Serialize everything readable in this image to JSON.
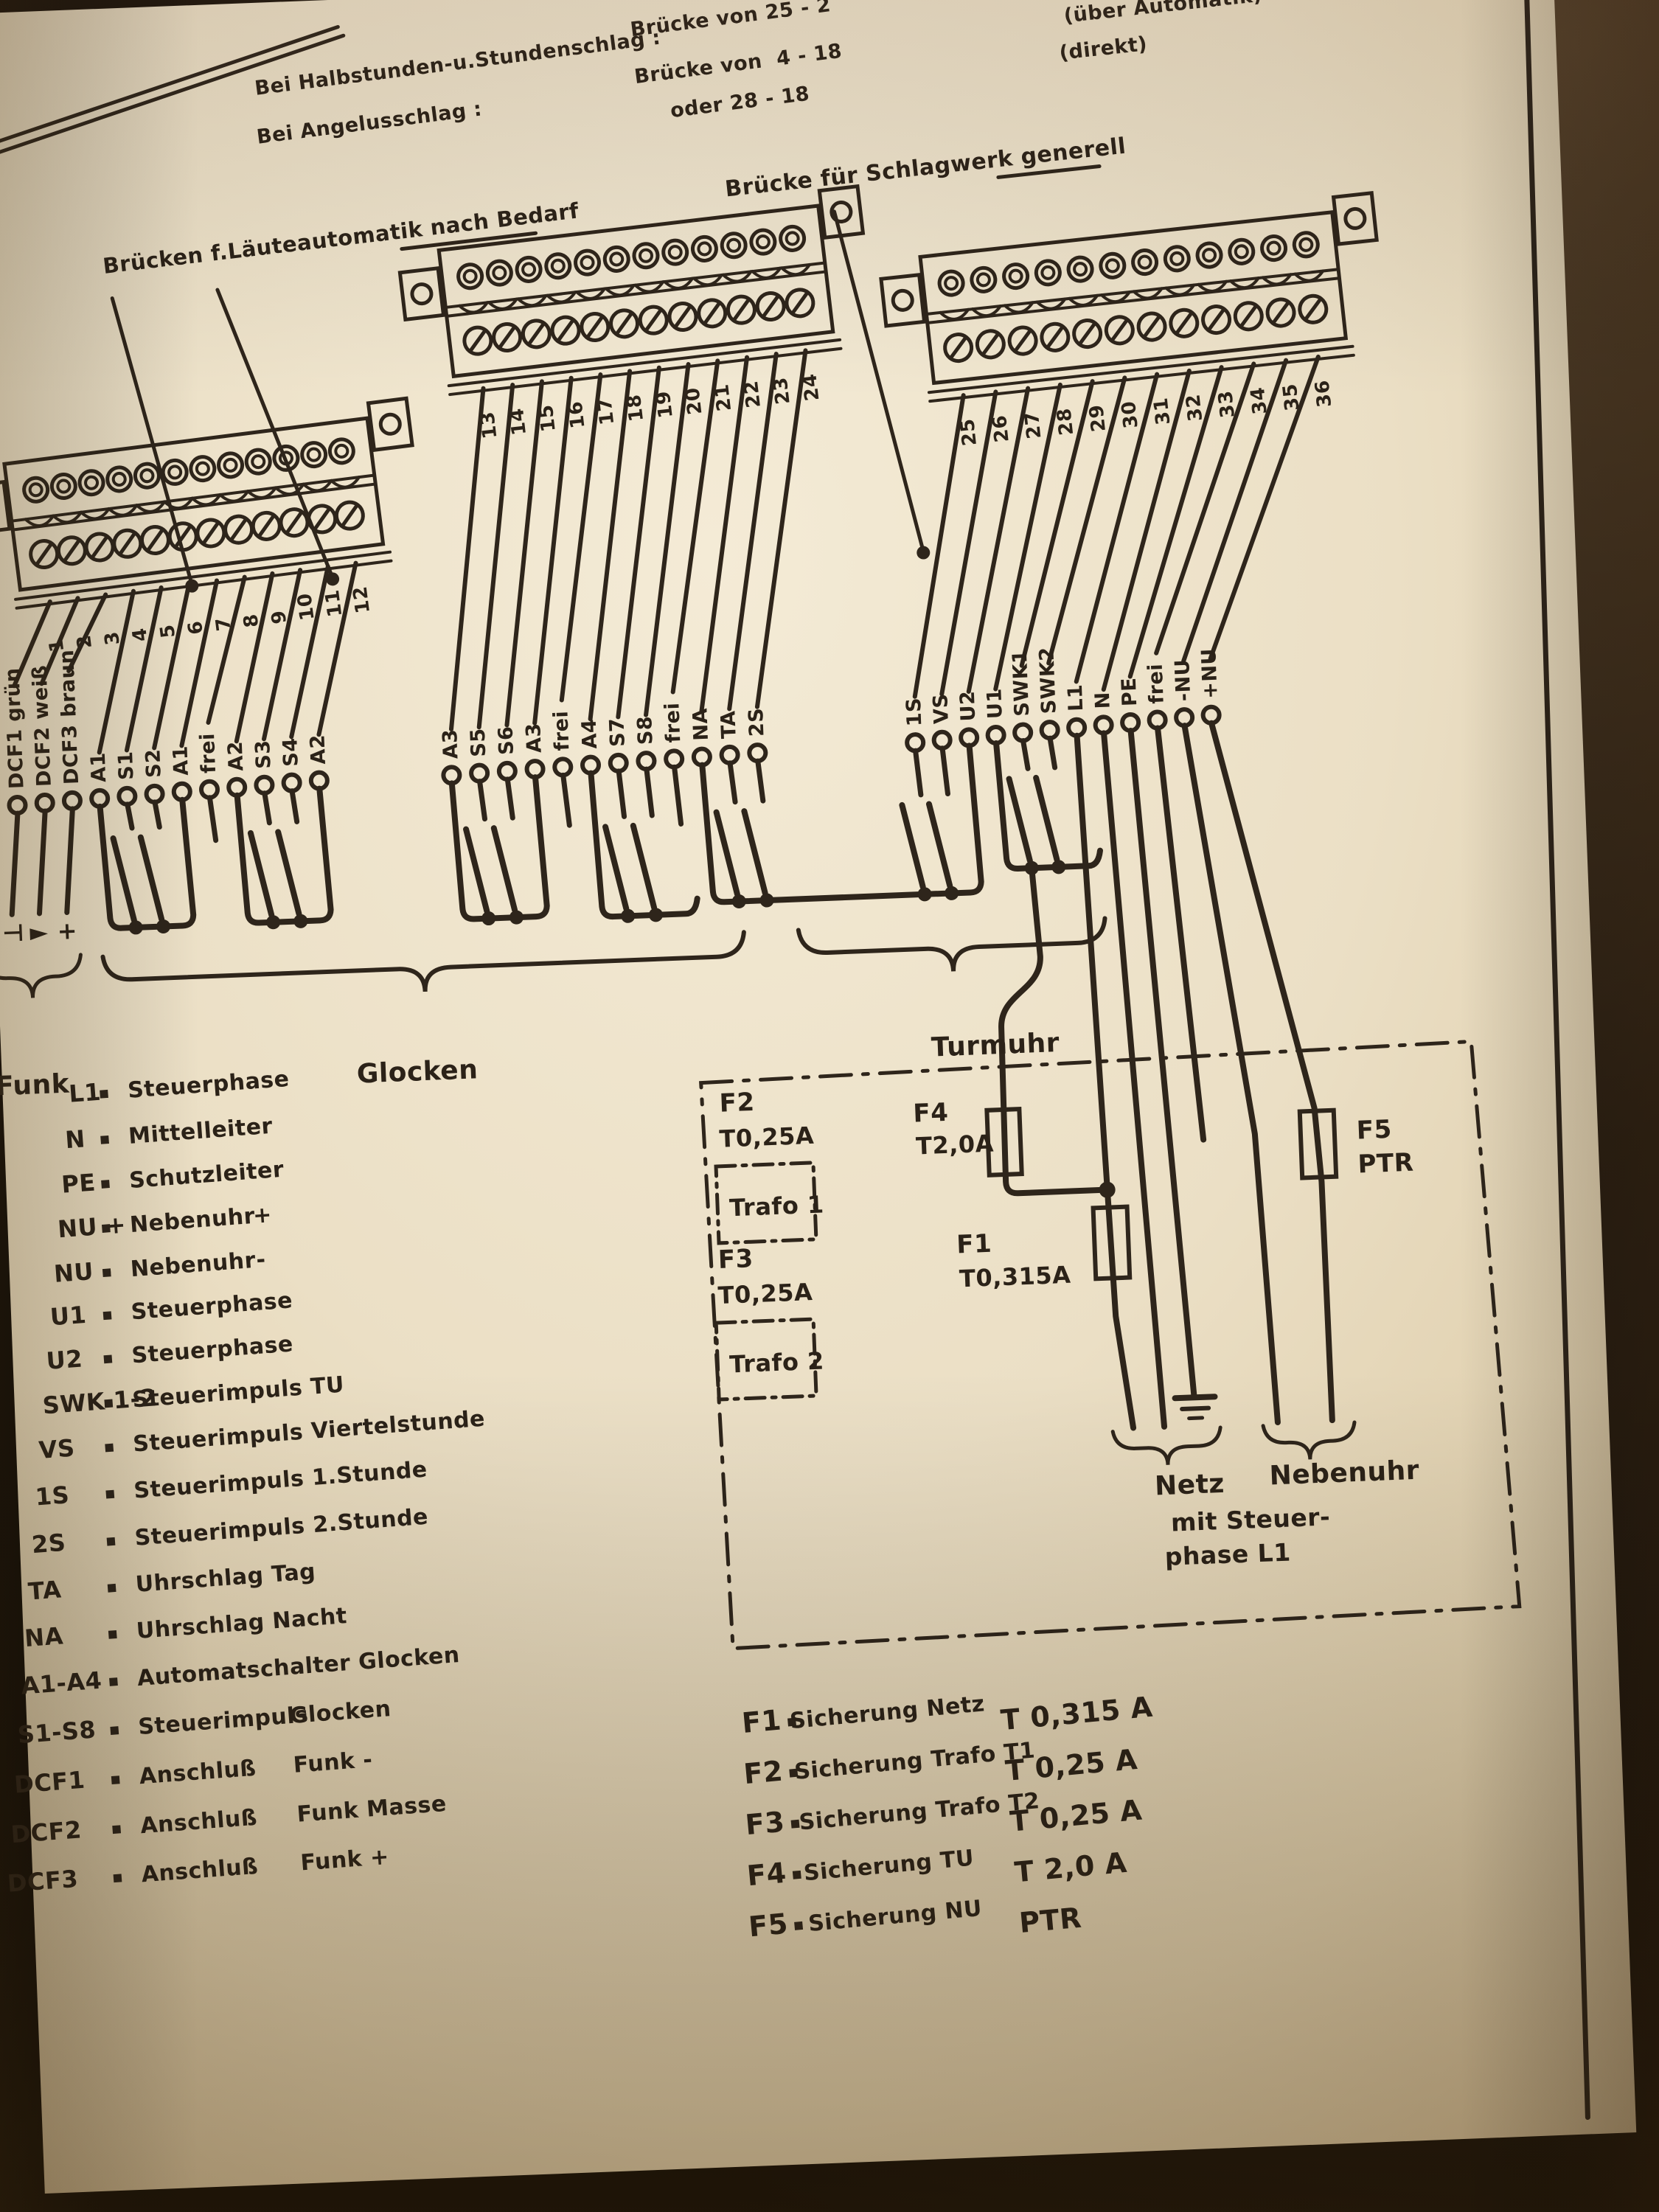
{
  "top_notes": {
    "line1_label": "Bei Halbstunden-u.Stundenschlag :",
    "line1_value": "Brücke von 25 - 2",
    "line1_note": "(über Automatik)",
    "line2_label": "Bei Angelusschlag :",
    "line2_value": "Brücke von  4 - 18",
    "line2_note": "(direkt)",
    "line3_value": "oder 28 - 18"
  },
  "headings": {
    "laeuteautomatik": "Brücken f.Läuteautomatik nach Bedarf",
    "schlagwerk": "Brücke für Schlagwerk generell"
  },
  "strips": [
    {
      "numbers": [
        "1",
        "2",
        "3",
        "4",
        "5",
        "6",
        "7",
        "8",
        "9",
        "10",
        "11",
        "12"
      ],
      "wires": [
        "DCF1 grün",
        "DCF2 weiß",
        "DCF3 braun",
        "A1",
        "S1",
        "S2",
        "A1",
        "frei",
        "A2",
        "S3",
        "S4",
        "A2"
      ]
    },
    {
      "numbers": [
        "13",
        "14",
        "15",
        "16",
        "17",
        "18",
        "19",
        "20",
        "21",
        "22",
        "23",
        "24"
      ],
      "wires": [
        "A3",
        "S5",
        "S6",
        "A3",
        "frei",
        "A4",
        "S7",
        "S8",
        "frei",
        "NA",
        "TA",
        "2S"
      ]
    },
    {
      "numbers": [
        "25",
        "26",
        "27",
        "28",
        "29",
        "30",
        "31",
        "32",
        "33",
        "34",
        "35",
        "36"
      ],
      "wires": [
        "1S",
        "VS",
        "U2",
        "U1",
        "SWK1",
        "SWK2",
        "L1",
        "N",
        "PE",
        "frei",
        "-NU",
        "+NU"
      ]
    }
  ],
  "sections": {
    "funk": "Funk",
    "glocken": "Glocken",
    "turmuhr": "Turmuhr"
  },
  "funk_symbols": [
    "⊣",
    "►",
    "+"
  ],
  "legend": [
    {
      "code": "L1",
      "desc": "Steuerphase",
      "extra": ""
    },
    {
      "code": "N",
      "desc": "Mittelleiter",
      "extra": ""
    },
    {
      "code": "PE",
      "desc": "Schutzleiter",
      "extra": ""
    },
    {
      "code": "NU +",
      "desc": "Nebenuhr",
      "extra": "+"
    },
    {
      "code": "NU -",
      "desc": "Nebenuhr",
      "extra": "-"
    },
    {
      "code": "U1",
      "desc": "Steuerphase",
      "extra": ""
    },
    {
      "code": "U2",
      "desc": "Steuerphase",
      "extra": ""
    },
    {
      "code": "SWK 1-2",
      "desc": "Steuerimpuls TU",
      "extra": ""
    },
    {
      "code": "VS",
      "desc": "Steuerimpuls Viertelstunde",
      "extra": ""
    },
    {
      "code": "1S",
      "desc": "Steuerimpuls 1.Stunde",
      "extra": ""
    },
    {
      "code": "2S",
      "desc": "Steuerimpuls 2.Stunde",
      "extra": ""
    },
    {
      "code": "TA",
      "desc": "Uhrschlag Tag",
      "extra": ""
    },
    {
      "code": "NA",
      "desc": "Uhrschlag Nacht",
      "extra": ""
    },
    {
      "code": "A1-A4",
      "desc": "Automatschalter Glocken",
      "extra": ""
    },
    {
      "code": "S1-S8",
      "desc": "Steuerimpuls",
      "extra": "Glocken"
    },
    {
      "code": "DCF1",
      "desc": "Anschluß",
      "extra": "Funk -"
    },
    {
      "code": "DCF2",
      "desc": "Anschluß",
      "extra": "Funk Masse"
    },
    {
      "code": "DCF3",
      "desc": "Anschluß",
      "extra": "Funk +"
    }
  ],
  "box": {
    "f2_name": "F2",
    "f2_rating": "T0,25A",
    "trafo1": "Trafo 1",
    "f3_name": "F3",
    "f3_rating": "T0,25A",
    "trafo2": "Trafo 2",
    "f4_name": "F4",
    "f4_rating": "T2,0A",
    "f1_name": "F1",
    "f1_rating": "T0,315A",
    "f5_name": "F5",
    "f5_rating": "PTR",
    "netz": "Netz",
    "netz_sub1": "mit Steuer-",
    "netz_sub2": "phase L1",
    "nebenuhr": "Nebenuhr"
  },
  "fuse_legend": [
    {
      "code": "F1",
      "desc": "Sicherung Netz",
      "value": "T 0,315 A"
    },
    {
      "code": "F2",
      "desc": "Sicherung Trafo T1",
      "value": "T 0,25 A"
    },
    {
      "code": "F3",
      "desc": "Sicherung Trafo T2",
      "value": "T 0,25 A"
    },
    {
      "code": "F4",
      "desc": "Sicherung TU",
      "value": "T 2,0 A"
    },
    {
      "code": "F5",
      "desc": "Sicherung NU",
      "value": "PTR"
    }
  ],
  "colors": {
    "ink": "#2e251b",
    "paper": "#e9dcc2"
  }
}
